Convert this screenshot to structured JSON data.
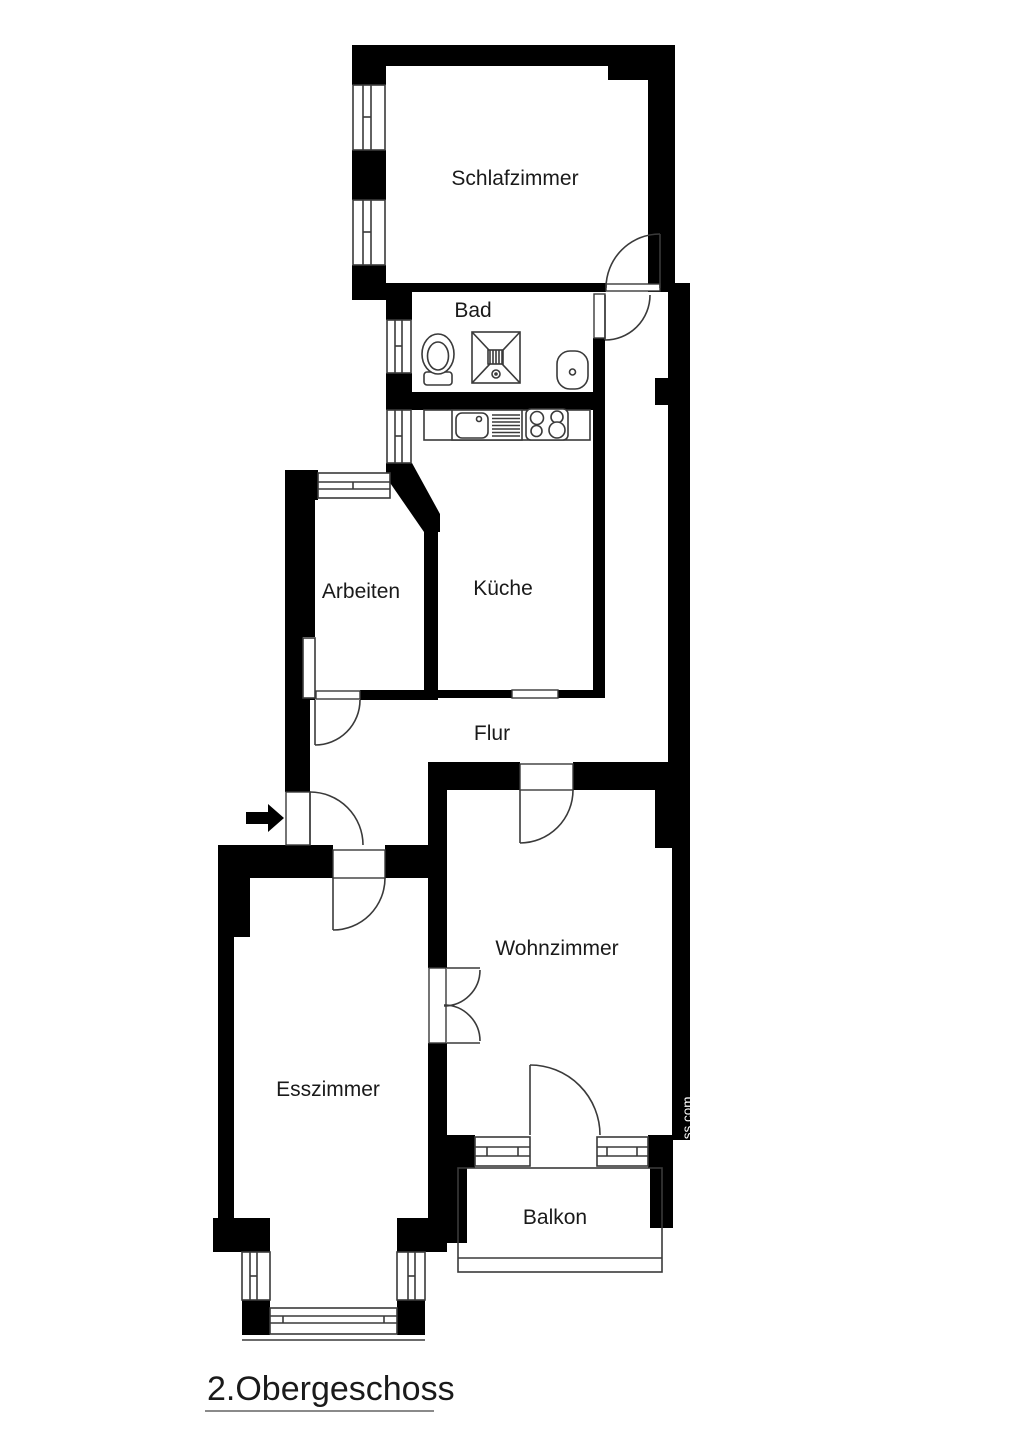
{
  "title": "2.Obergeschoss",
  "watermark": "www.grundriss.com",
  "rooms": {
    "schlafzimmer": {
      "label": "Schlafzimmer"
    },
    "bad": {
      "label": "Bad"
    },
    "kueche": {
      "label": "Küche"
    },
    "arbeiten": {
      "label": "Arbeiten"
    },
    "flur": {
      "label": "Flur"
    },
    "wohnzimmer": {
      "label": "Wohnzimmer"
    },
    "esszimmer": {
      "label": "Esszimmer"
    },
    "balkon": {
      "label": "Balkon"
    }
  },
  "colors": {
    "wall": "#000000",
    "background": "#ffffff",
    "line": "#3a3a3a",
    "label": "#1a1a1a",
    "watermark_text": "#ffffff",
    "underline": "#8a8a8a"
  }
}
